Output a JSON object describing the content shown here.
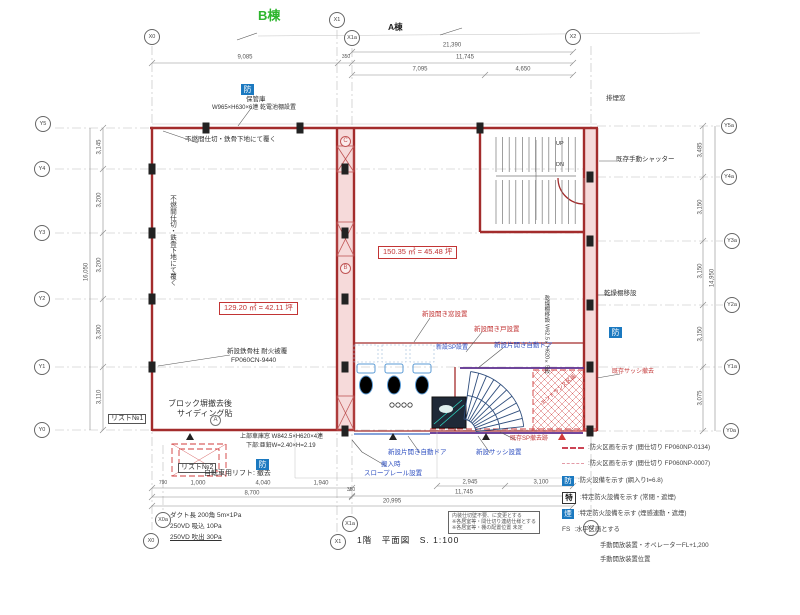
{
  "title": {
    "text": "1階　平面図　S. 1:100"
  },
  "building_labels": {
    "b_wing": "B棟",
    "a_wing": "A棟"
  },
  "grid_bubbles": [
    {
      "label": "X0",
      "x": 152,
      "y": 37
    },
    {
      "label": "X1",
      "x": 337,
      "y": 20
    },
    {
      "label": "X1a",
      "x": 352,
      "y": 38
    },
    {
      "label": "X2",
      "x": 573,
      "y": 37
    },
    {
      "label": "Y5",
      "x": 43,
      "y": 124
    },
    {
      "label": "Y4",
      "x": 42,
      "y": 169
    },
    {
      "label": "Y3",
      "x": 42,
      "y": 233
    },
    {
      "label": "Y2",
      "x": 42,
      "y": 299
    },
    {
      "label": "Y1",
      "x": 42,
      "y": 367
    },
    {
      "label": "Y0",
      "x": 42,
      "y": 430
    },
    {
      "label": "Y5a",
      "x": 729,
      "y": 126
    },
    {
      "label": "Y4a",
      "x": 729,
      "y": 177
    },
    {
      "label": "Y3a",
      "x": 732,
      "y": 241
    },
    {
      "label": "Y2a",
      "x": 732,
      "y": 305
    },
    {
      "label": "Y1a",
      "x": 732,
      "y": 367
    },
    {
      "label": "Y0a",
      "x": 731,
      "y": 431
    },
    {
      "label": "X0a",
      "x": 163,
      "y": 520
    },
    {
      "label": "X0",
      "x": 151,
      "y": 541
    },
    {
      "label": "X1a",
      "x": 350,
      "y": 524
    },
    {
      "label": "X1",
      "x": 338,
      "y": 542
    },
    {
      "label": "X2",
      "x": 591,
      "y": 528
    }
  ],
  "dimensions": [
    {
      "t": "21,390",
      "x": 452,
      "y": 46
    },
    {
      "t": "9,085",
      "x": 245,
      "y": 58
    },
    {
      "t": "350",
      "x": 346,
      "y": 58,
      "s": 5
    },
    {
      "t": "11,745",
      "x": 465,
      "y": 58
    },
    {
      "t": "7,095",
      "x": 420,
      "y": 70
    },
    {
      "t": "4,650",
      "x": 523,
      "y": 70
    },
    {
      "t": "3,145",
      "x": 100,
      "y": 147,
      "rot": -90
    },
    {
      "t": "3,200",
      "x": 100,
      "y": 200,
      "rot": -90
    },
    {
      "t": "3,200",
      "x": 100,
      "y": 265,
      "rot": -90
    },
    {
      "t": "3,300",
      "x": 100,
      "y": 332,
      "rot": -90
    },
    {
      "t": "3,110",
      "x": 100,
      "y": 397,
      "rot": -90
    },
    {
      "t": "16,050",
      "x": 87,
      "y": 272,
      "rot": -90
    },
    {
      "t": "3,485",
      "x": 701,
      "y": 150,
      "rot": -90
    },
    {
      "t": "3,150",
      "x": 701,
      "y": 207,
      "rot": -90
    },
    {
      "t": "3,150",
      "x": 701,
      "y": 271,
      "rot": -90
    },
    {
      "t": "3,150",
      "x": 701,
      "y": 334,
      "rot": -90
    },
    {
      "t": "3,075",
      "x": 701,
      "y": 398,
      "rot": -90
    },
    {
      "t": "14,950",
      "x": 713,
      "y": 278,
      "rot": -90
    },
    {
      "t": "790",
      "x": 163,
      "y": 484,
      "s": 5
    },
    {
      "t": "1,000",
      "x": 198,
      "y": 484
    },
    {
      "t": "4,040",
      "x": 263,
      "y": 484
    },
    {
      "t": "1,940",
      "x": 321,
      "y": 484
    },
    {
      "t": "8,700",
      "x": 252,
      "y": 494
    },
    {
      "t": "350",
      "x": 351,
      "y": 491,
      "s": 5
    },
    {
      "t": "2,945",
      "x": 470,
      "y": 483
    },
    {
      "t": "3,100",
      "x": 541,
      "y": 483
    },
    {
      "t": "11,745",
      "x": 464,
      "y": 493
    },
    {
      "t": "20,995",
      "x": 392,
      "y": 502
    }
  ],
  "area_labels": [
    {
      "text": "129.20 ㎡ = 42.11 坪",
      "x": 219,
      "y": 302
    },
    {
      "text": "150.35 ㎡ = 45.48 坪",
      "x": 378,
      "y": 246
    }
  ],
  "annotations": [
    {
      "text": "保管庫",
      "x": 246,
      "y": 96,
      "size": 6.5
    },
    {
      "text": "W965×H630×6連 乾電池棚設置",
      "x": 212,
      "y": 105,
      "size": 6
    },
    {
      "text": "不燃間仕切・鉄骨下地にて覆く",
      "x": 185,
      "y": 136,
      "size": 6.5
    },
    {
      "text": "不燃間仕切・鉄骨下地にて覆く",
      "x": 168,
      "y": 195,
      "size": 6.5,
      "vert": true
    },
    {
      "text": "新設鉄骨柱 耐火被覆",
      "x": 227,
      "y": 348,
      "size": 6.5
    },
    {
      "text": "FP060CN-9440",
      "x": 231,
      "y": 357,
      "size": 6.5
    },
    {
      "text": "ブロック塀撤去後",
      "x": 168,
      "y": 399,
      "size": 8
    },
    {
      "text": "サイディング貼",
      "x": 177,
      "y": 409,
      "size": 8
    },
    {
      "text": "リスト№1",
      "x": 108,
      "y": 414,
      "size": 7,
      "boxed": true
    },
    {
      "text": "リスト№2",
      "x": 178,
      "y": 463,
      "size": 7,
      "boxed": true
    },
    {
      "text": "上部車庫窓 W842.5×H620×4連",
      "x": 240,
      "y": 434,
      "size": 6
    },
    {
      "text": "下部:亜鉛W=2.40×H=2.19",
      "x": 246,
      "y": 443,
      "size": 6
    },
    {
      "text": "自転車用リフト: 撤去",
      "x": 204,
      "y": 470,
      "size": 7
    },
    {
      "text": "ダクト長 200角 5m×1Pa",
      "x": 170,
      "y": 512,
      "size": 6.5
    },
    {
      "text": "250VD 吸込 10Pa",
      "x": 170,
      "y": 523,
      "size": 6.5
    },
    {
      "text": "250VD 吹出 30Pa",
      "x": 170,
      "y": 534,
      "size": 6.5,
      "underline": true
    },
    {
      "text": "既存手動シャッター",
      "x": 616,
      "y": 156,
      "size": 6.5
    },
    {
      "text": "排煙窓",
      "x": 606,
      "y": 95,
      "size": 6.5
    },
    {
      "text": "乾燥棚移設",
      "x": 604,
      "y": 290,
      "size": 6.5
    },
    {
      "text": "乾燥棚移設 W62.5×H620×5段",
      "x": 543,
      "y": 295,
      "size": 5.5,
      "vert": true
    },
    {
      "text": "UP",
      "x": 556,
      "y": 141,
      "size": 5.5
    },
    {
      "text": "DN",
      "x": 556,
      "y": 162,
      "size": 5.5
    },
    {
      "text": "新設開き窓設置",
      "x": 422,
      "y": 311,
      "size": 6.5,
      "color": "red"
    },
    {
      "text": "新設開き戸設置",
      "x": 474,
      "y": 326,
      "size": 6.5,
      "color": "red"
    },
    {
      "text": "既存SP撤去跡",
      "x": 510,
      "y": 436,
      "size": 6,
      "color": "red"
    },
    {
      "text": "既存サッシ撤去",
      "x": 612,
      "y": 369,
      "size": 6,
      "color": "red"
    },
    {
      "text": "エントランス区画",
      "x": 540,
      "y": 402,
      "size": 5.5,
      "color": "red",
      "rot": -40
    },
    {
      "text": "新設SP設置",
      "x": 436,
      "y": 345,
      "size": 6,
      "color": "blue"
    },
    {
      "text": "新設片開き自動ドア",
      "x": 494,
      "y": 342,
      "size": 6.5,
      "color": "blue"
    },
    {
      "text": "新設片開き自動ドア",
      "x": 388,
      "y": 449,
      "size": 6.5,
      "color": "blue"
    },
    {
      "text": "新設サッシ設置",
      "x": 476,
      "y": 449,
      "size": 6.5,
      "color": "blue"
    },
    {
      "text": "搬入時",
      "x": 381,
      "y": 461,
      "size": 6.5,
      "color": "blue"
    },
    {
      "text": "スロープレール設置",
      "x": 364,
      "y": 470,
      "size": 6.5,
      "color": "blue"
    }
  ],
  "fire_marks": [
    {
      "label": "防",
      "x": 241,
      "y": 84
    },
    {
      "label": "防",
      "x": 609,
      "y": 327
    },
    {
      "label": "防",
      "x": 256,
      "y": 459
    }
  ],
  "circle_letters": [
    {
      "label": "C",
      "x": 345,
      "y": 141,
      "color": "red"
    },
    {
      "label": "B",
      "x": 345,
      "y": 268,
      "color": "red"
    },
    {
      "label": "A",
      "x": 215,
      "y": 420,
      "color": "gray"
    }
  ],
  "legend": {
    "items": [
      {
        "type": "dash-red",
        "label": "防火区画を示す (間仕切り FP060NP-0134)"
      },
      {
        "type": "dash-pink",
        "label": "防火区画を示す (間仕切り FP060NP-0007)"
      },
      {
        "type": "box-blue",
        "symbol": "防",
        "label": "防火設備を示す (網入りt=6.8)"
      },
      {
        "type": "box-plain",
        "symbol": "特",
        "label": "特定防火設備を示す (常閉・遮煙)"
      },
      {
        "type": "box-blue",
        "symbol": "煙",
        "label": "特定防火設備を示す (煙感連動・遮煙)"
      },
      {
        "type": "textsym",
        "symbol": "FS",
        "label": "水平区画とする"
      },
      {
        "type": "none",
        "label": "手動開放装置・オペレーターFL+1,200"
      },
      {
        "type": "none",
        "label": "手動開放装置位置"
      }
    ],
    "rows_y": [
      444,
      460,
      476,
      492,
      509,
      526,
      542,
      556
    ]
  },
  "note_box": {
    "x": 448,
    "y": 511,
    "lines": [
      "内装仕切壁不要、に変更とする",
      "※各居室等・間仕切り連結仕様とする",
      "※各居室等・棚の配置位置 未定"
    ]
  },
  "colors": {
    "wall_red": "#a32c2c",
    "annotation_blue": "#2e4fc0",
    "annotation_red": "#c23434",
    "fire_badge_blue": "#1b79c0",
    "wing_green": "#2db52d",
    "new_wall_purple": "#5b2d8e"
  }
}
